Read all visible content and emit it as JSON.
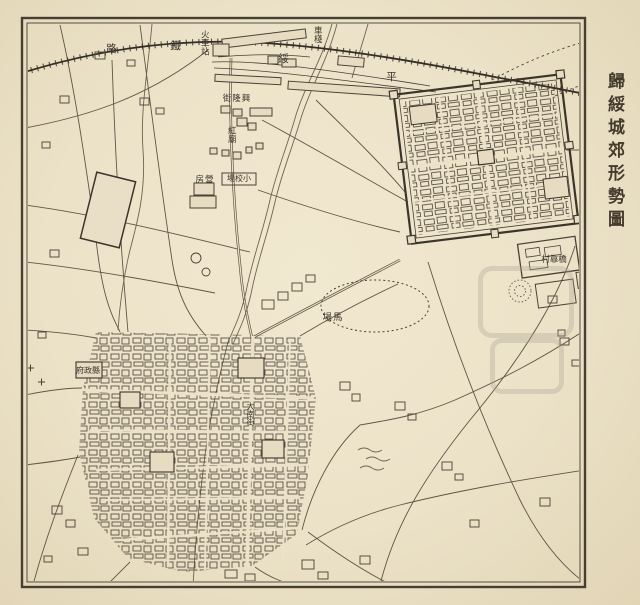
{
  "page": {
    "title": "歸綏城郊形勢圖"
  },
  "map": {
    "railway_label_chars": [
      {
        "ch": "路"
      },
      {
        "ch": "鐵"
      },
      {
        "ch": "綏"
      },
      {
        "ch": "平"
      }
    ],
    "labels": [
      {
        "id": "train-station",
        "text": "火車站"
      },
      {
        "id": "freight-depot",
        "text": "車棧"
      },
      {
        "id": "xinglong-street",
        "text": "興隆街"
      },
      {
        "id": "red-temple",
        "text": "紅廟"
      },
      {
        "id": "barracks",
        "text": "營房"
      },
      {
        "id": "small-drill-ground",
        "text": "小校場"
      },
      {
        "id": "horse-ground",
        "text": "馬場"
      },
      {
        "id": "qiaokao-village",
        "text": "橋靠村"
      },
      {
        "id": "county-government",
        "text": "縣政府"
      },
      {
        "id": "south-main-street",
        "text": "大南街"
      }
    ],
    "line_color": "#5f5546",
    "ink_color": "#3b332a",
    "paper_color": "#ece2c8"
  }
}
